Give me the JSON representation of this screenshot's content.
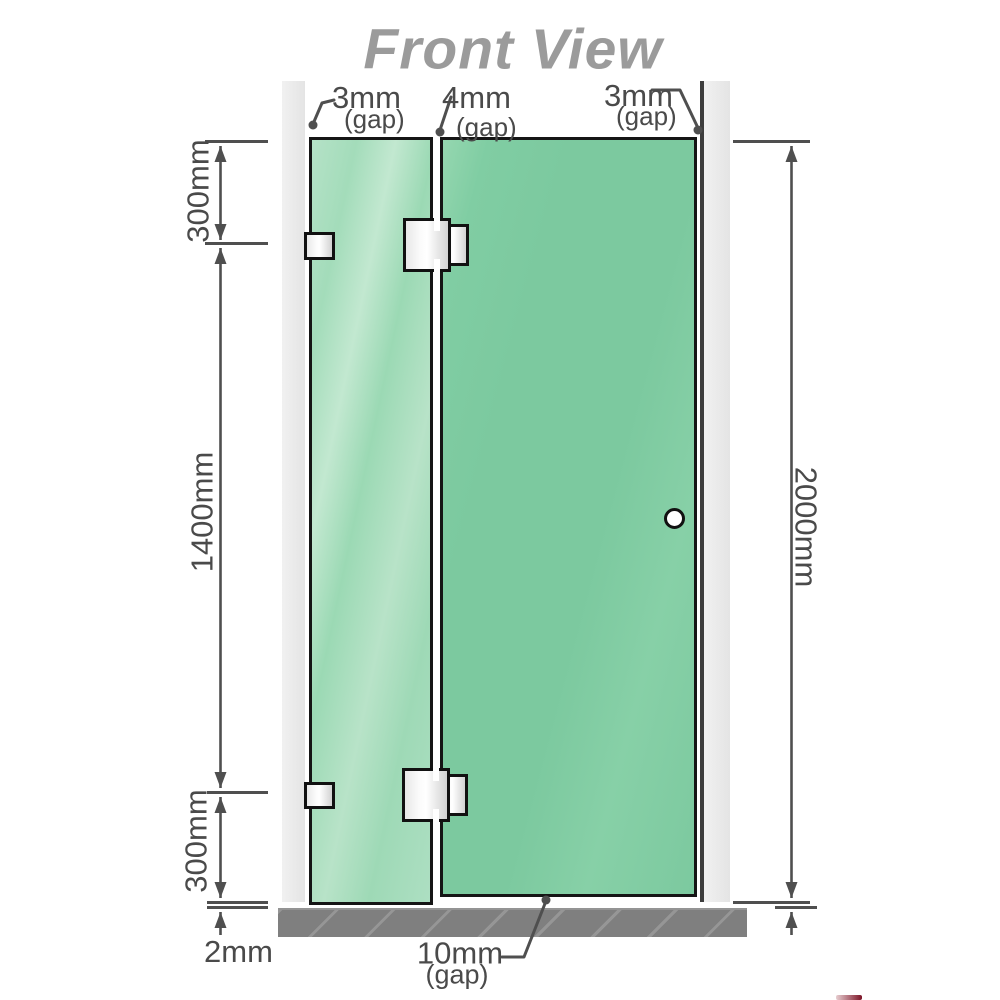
{
  "title": "Front View",
  "gaps": {
    "top_left": {
      "value": "3mm",
      "label": "(gap)"
    },
    "top_middle": {
      "value": "4mm",
      "label": "(gap)"
    },
    "top_right": {
      "value": "3mm",
      "label": "(gap)"
    },
    "bottom": {
      "value": "10mm",
      "label": "(gap)"
    },
    "floor_left": {
      "value": "2mm"
    }
  },
  "dimensions": {
    "left_top": "300mm",
    "left_middle": "1400mm",
    "left_bottom": "300mm",
    "right_full": "2000mm"
  },
  "colors": {
    "glass_fixed_panel": "#a9dcbd",
    "glass_door_panel": "#7cc99f",
    "wall": "#eaeaea",
    "floor": "#7f7f7f",
    "dimension_line": "#4f4f4f",
    "label_text": "#4a4a4a",
    "title_text": "#9b9b9b",
    "glass_border": "#151515",
    "logo_fragment_red": "#7c1326"
  }
}
